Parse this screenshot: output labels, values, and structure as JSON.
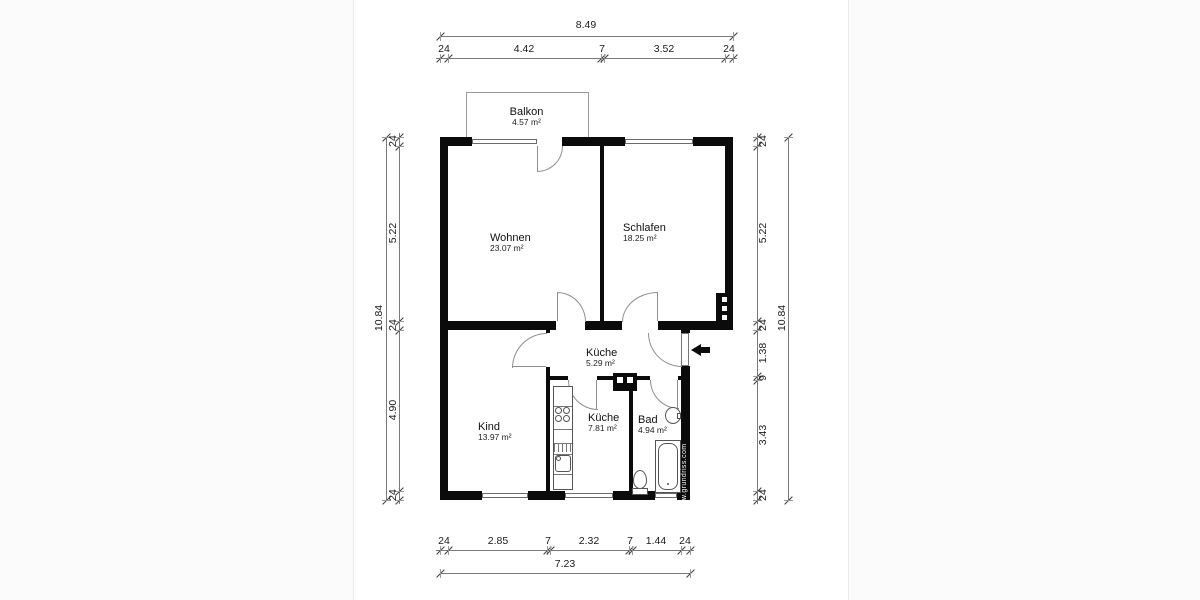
{
  "watermark": {
    "text": "www.grundriss.com"
  },
  "rooms": {
    "balkon": {
      "name": "Balkon",
      "area": "4.57 m²"
    },
    "wohnen": {
      "name": "Wohnen",
      "area": "23.07 m²"
    },
    "schlafen": {
      "name": "Schlafen",
      "area": "18.25 m²"
    },
    "kueche1": {
      "name": "Küche",
      "area": "5.29 m²"
    },
    "kind": {
      "name": "Kind",
      "area": "13.97 m²"
    },
    "kueche2": {
      "name": "Küche",
      "area": "7.81 m²"
    },
    "bad": {
      "name": "Bad",
      "area": "4.94 m²"
    }
  },
  "dimensions": {
    "top": {
      "total": "8.49",
      "segments": [
        "24",
        "4.42",
        "7",
        "3.52",
        "24"
      ]
    },
    "bottom": {
      "total": "7.23",
      "segments": [
        "24",
        "2.85",
        "7",
        "2.32",
        "7",
        "1.44",
        "24"
      ]
    },
    "left": {
      "total": "10.84",
      "segments": [
        "24",
        "5.22",
        "24",
        "4.90",
        "24"
      ]
    },
    "right": {
      "total": "10.84",
      "segments": [
        "24",
        "5.22",
        "24",
        "1.38",
        "9",
        "3.43",
        "24"
      ]
    }
  },
  "colors": {
    "wall": "#0b0b0b",
    "line": "#7a7a7a",
    "background": "#ffffff"
  }
}
